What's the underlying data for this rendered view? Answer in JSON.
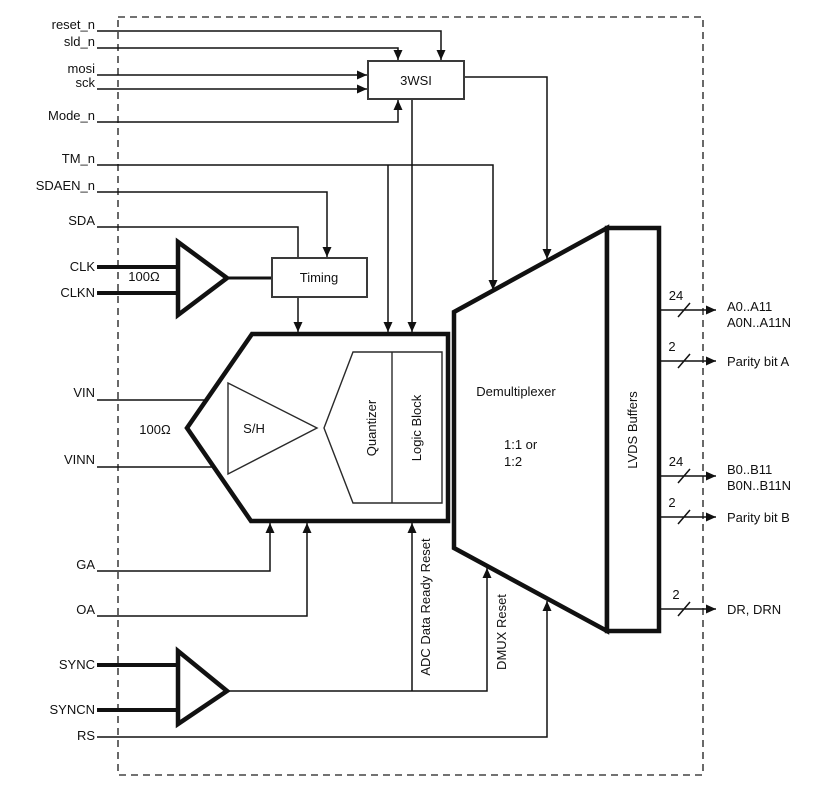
{
  "signals_left": [
    {
      "name": "reset_n"
    },
    {
      "name": "sld_n"
    },
    {
      "name": "mosi"
    },
    {
      "name": "sck"
    },
    {
      "name": "Mode_n"
    },
    {
      "name": "TM_n"
    },
    {
      "name": "SDAEN_n"
    },
    {
      "name": "SDA"
    },
    {
      "name": "CLK"
    },
    {
      "name": "CLKN"
    },
    {
      "name": "VIN"
    },
    {
      "name": "VINN"
    },
    {
      "name": "GA"
    },
    {
      "name": "OA"
    },
    {
      "name": "SYNC"
    },
    {
      "name": "SYNCN"
    },
    {
      "name": "RS"
    }
  ],
  "blocks": {
    "spi": "3WSI",
    "timing": "Timing",
    "sample_hold": "S/H",
    "quantizer": "Quantizer",
    "logic_block": "Logic Block",
    "demux": "Demultiplexer",
    "demux_mode_line1": "1:1 or",
    "demux_mode_line2": "1:2",
    "lvds": "LVDS Buffers"
  },
  "annotations": {
    "clk_termination": "100Ω",
    "vin_termination": "100Ω",
    "adc_data_ready_reset": "ADC Data Ready Reset",
    "dmux_reset": "DMUX Reset"
  },
  "outputs": [
    {
      "width": "24",
      "line1": "A0..A11",
      "line2": "A0N..A11N"
    },
    {
      "width": "2",
      "line1": "Parity bit A",
      "line2": ""
    },
    {
      "width": "24",
      "line1": "B0..B11",
      "line2": "B0N..B11N"
    },
    {
      "width": "2",
      "line1": "Parity bit B",
      "line2": ""
    },
    {
      "width": "2",
      "line1": "DR, DRN",
      "line2": ""
    }
  ],
  "colors": {
    "line": "#111111",
    "background": "#ffffff"
  }
}
